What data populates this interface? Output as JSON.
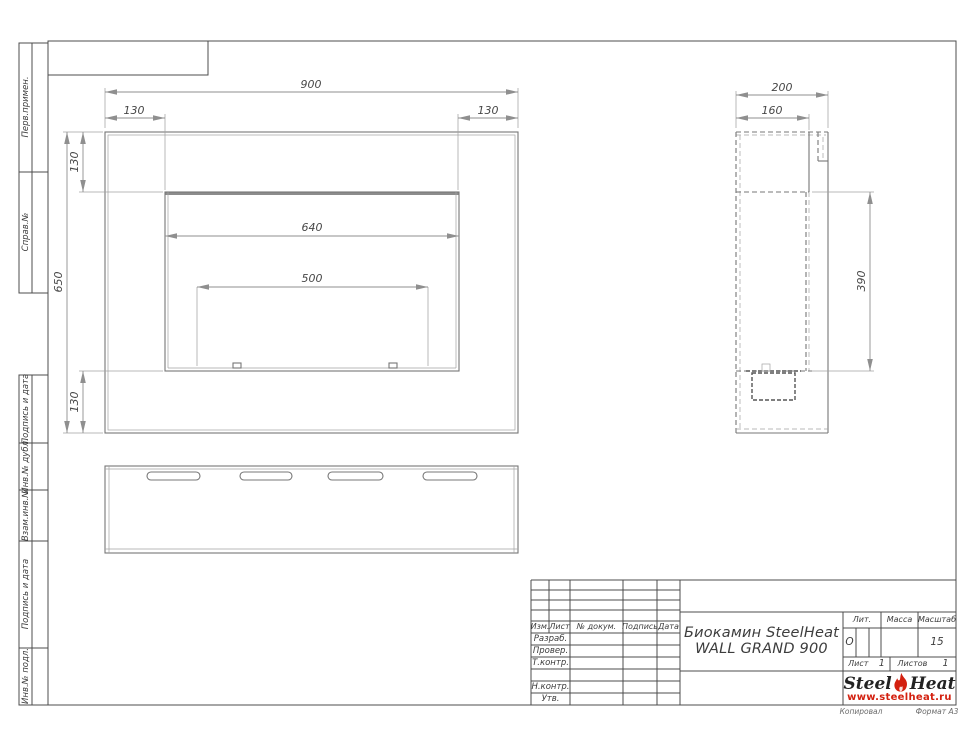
{
  "margin": {
    "items": [
      {
        "label": "Перв.примен."
      },
      {
        "label": "Справ.№"
      },
      {
        "label": "Подпись и дата"
      },
      {
        "label": "Инв.№ дубл."
      },
      {
        "label": "Взам.инв.№"
      },
      {
        "label": "Подпись и дата"
      },
      {
        "label": "Инв.№ подл."
      }
    ]
  },
  "dims": {
    "front_width": "900",
    "front_margin_left": "130",
    "front_margin_right": "130",
    "front_margin_top": "130",
    "front_height": "650",
    "front_margin_bottom": "130",
    "opening_width": "640",
    "burner_width": "500",
    "side_depth": "200",
    "side_body_depth": "160",
    "side_opening_height": "390"
  },
  "title_block": {
    "cols": {
      "izm": "Изм.",
      "list": "Лист",
      "dokum": "№ докум.",
      "podpis": "Подпись",
      "data": "Дата"
    },
    "rows": {
      "razrab": "Разраб.",
      "prover": "Провер.",
      "tkontr": "Т.контр.",
      "nkontr": "Н.контр.",
      "utv": "Утв."
    },
    "title_line1": "Биокамин SteelHeat",
    "title_line2": "WALL GRAND 900",
    "lit_label": "Лит.",
    "lit_value": "О",
    "massa_label": "Масса",
    "masshtab_label": "Масштаб",
    "masshtab_value": "15",
    "list_label": "Лист",
    "list_value": "1",
    "listov_label": "Листов",
    "listov_value": "1",
    "logo_steel": "Steel",
    "logo_heat": "Heat",
    "logo_url": "www.steelheat.ru",
    "footer_left": "Копировал",
    "footer_right": "Формат А3",
    "accent_color": "#d3200f"
  }
}
